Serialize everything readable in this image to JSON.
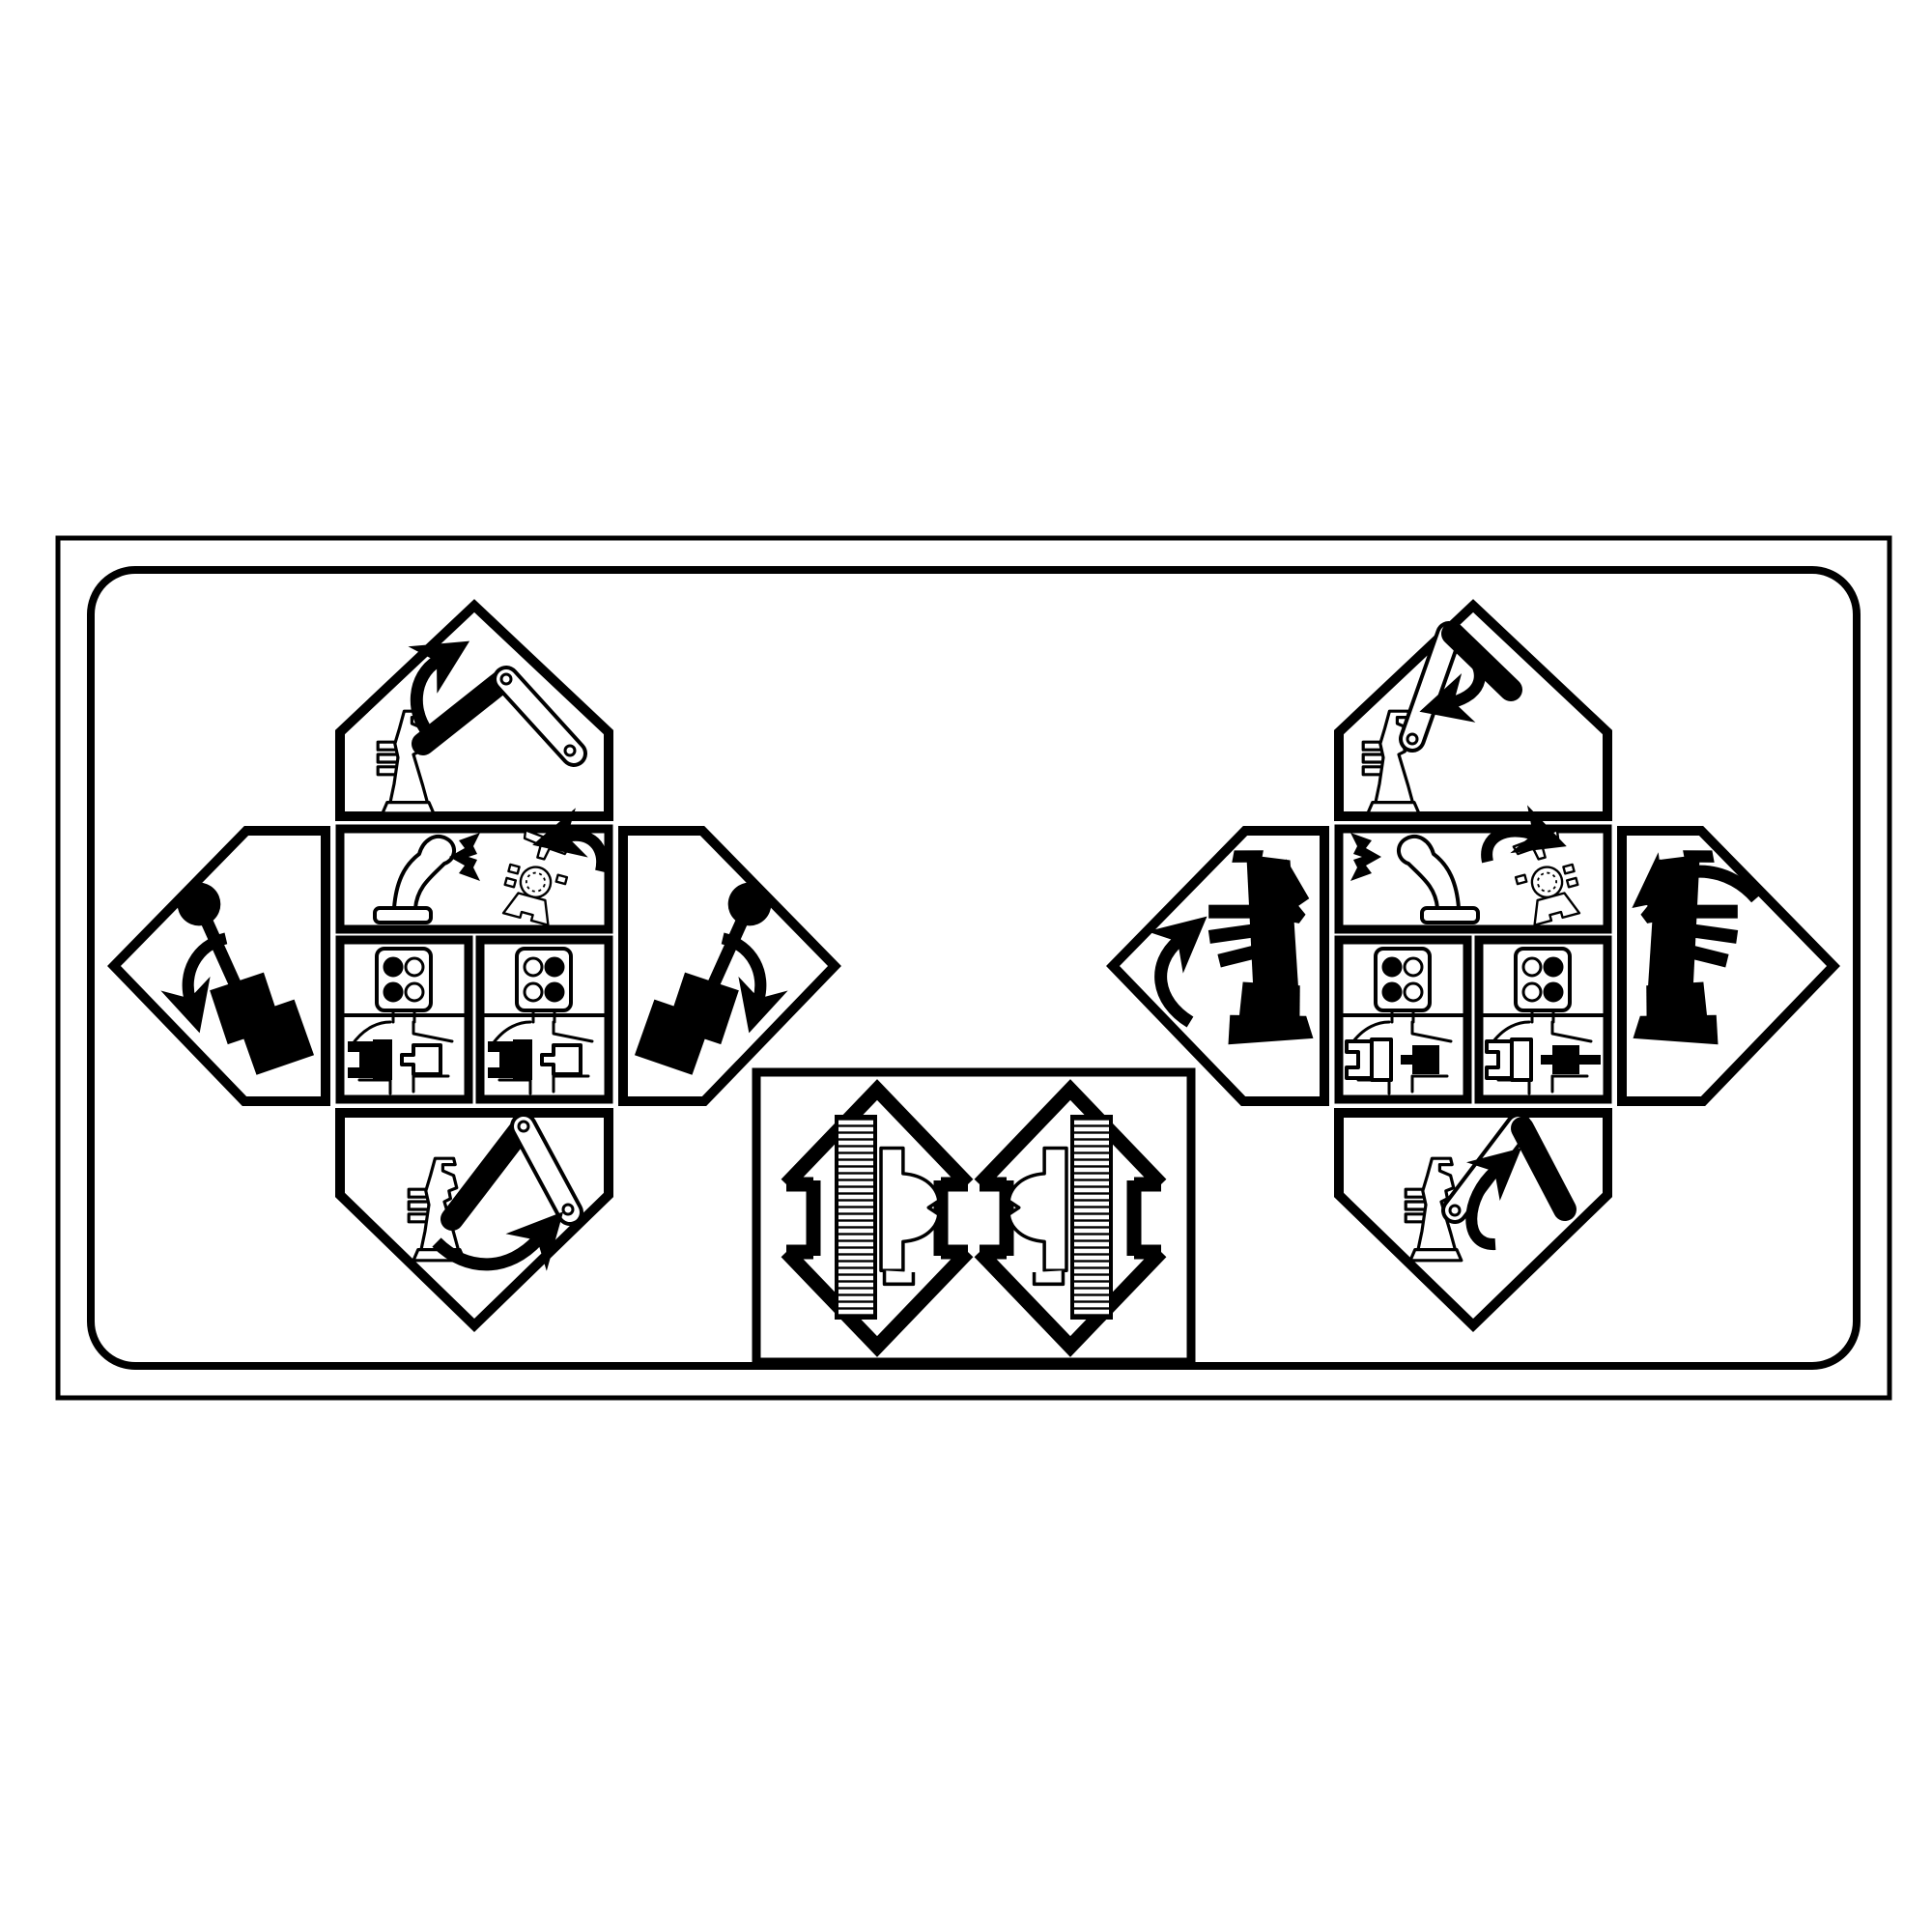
{
  "title": "Two-lever hydraulic control pattern decal",
  "colors": {
    "ink": "#000000",
    "paper": "#ffffff"
  },
  "decal": {
    "kind": "control-pattern-plate",
    "left_cluster": {
      "label": "left control lever pattern cluster",
      "up_panel": {
        "icon": "excavator-arm-raise-icon",
        "desc": "lever forward: boom link rotates up"
      },
      "down_panel": {
        "icon": "excavator-arm-lower-icon",
        "desc": "lever back: stick link swings out"
      },
      "left_panel": {
        "icon": "control-lever-tilt-left-icon",
        "desc": "lever tilted left with down-left arrow"
      },
      "right_panel": {
        "icon": "control-lever-tilt-right-icon",
        "desc": "lever tilted right with down-right arrow"
      },
      "wide_panel": {
        "icon": "joystick-and-swing-topview-icon",
        "desc": "joystick leaning right, black flag arrow, upper-structure swing counter-clockwise"
      },
      "square_a": {
        "icon": "pattern-port-plate-icon",
        "dots": [
          "#000000",
          "#ffffff",
          "#000000",
          "#ffffff"
        ],
        "mini": {
          "tractor": "#000000",
          "plug": "#ffffff"
        }
      },
      "square_b": {
        "icon": "pattern-port-plate-icon",
        "dots": [
          "#ffffff",
          "#000000",
          "#ffffff",
          "#000000"
        ],
        "mini": {
          "tractor": "#000000",
          "plug": "#ffffff"
        }
      }
    },
    "right_cluster": {
      "label": "right control lever pattern cluster",
      "up_panel": {
        "icon": "excavator-arm-lower-icon",
        "desc": "lever forward: black stick drops, arrow down"
      },
      "down_panel": {
        "icon": "excavator-arm-curl-icon",
        "desc": "lever back: black stick curls in, arrow up"
      },
      "left_panel": {
        "icon": "machine-swing-left-icon",
        "desc": "black machine silhouette, arrow curling up-left"
      },
      "right_panel": {
        "icon": "machine-swing-right-icon",
        "desc": "black machine silhouette, arrow curling over top"
      },
      "wide_panel": {
        "icon": "joystick-and-swing-topview-icon",
        "desc": "black flag arrow, joystick leaning left, upper-structure swing clockwise"
      },
      "square_a": {
        "icon": "pattern-port-plate-icon",
        "dots": [
          "#000000",
          "#ffffff",
          "#000000",
          "#ffffff"
        ],
        "mini": {
          "tractor": "#ffffff",
          "plug": "#000000"
        }
      },
      "square_b": {
        "icon": "pattern-port-plate-icon",
        "dots": [
          "#ffffff",
          "#000000",
          "#ffffff",
          "#000000"
        ],
        "mini": {
          "tractor": "#ffffff",
          "plug": "#000000"
        }
      }
    },
    "travel_box": {
      "label": "travel controls",
      "left_arrow": {
        "icon": "double-headed-arrow-icon",
        "content": "left-track-tread-and-pedal"
      },
      "right_arrow": {
        "icon": "double-headed-arrow-icon",
        "content": "right-track-tread-and-pedal"
      }
    }
  }
}
